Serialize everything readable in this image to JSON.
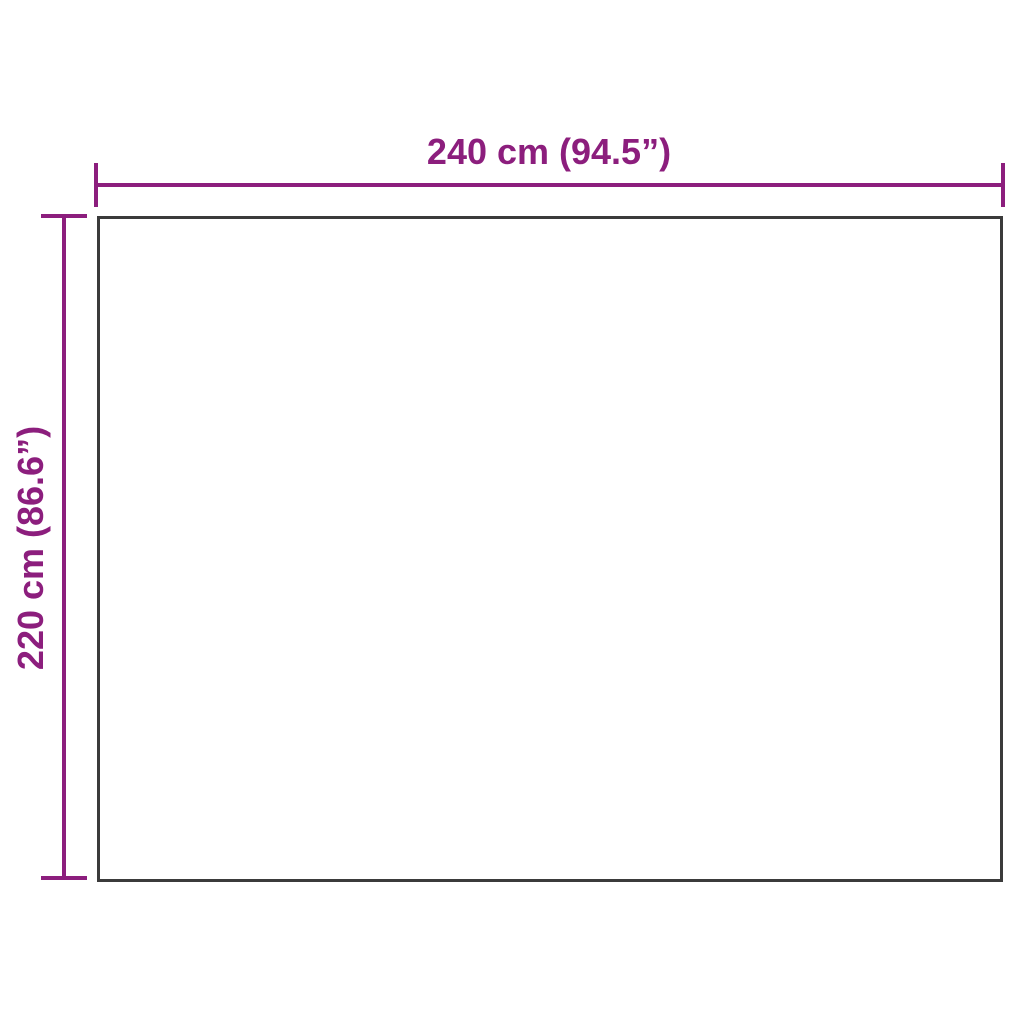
{
  "diagram": {
    "type": "product-dimension-diagram",
    "dimensions": {
      "width": {
        "label": "240 cm (94.5”)",
        "value_cm": 240,
        "value_inches": 94.5
      },
      "height": {
        "label": "220 cm (86.6”)",
        "value_cm": 220,
        "value_inches": 86.6
      }
    }
  },
  "colors": {
    "dimension": "#8C1E7D",
    "outline": "#3B3B3B",
    "background": "#FFFFFF",
    "surface": "#FFFFFF"
  }
}
